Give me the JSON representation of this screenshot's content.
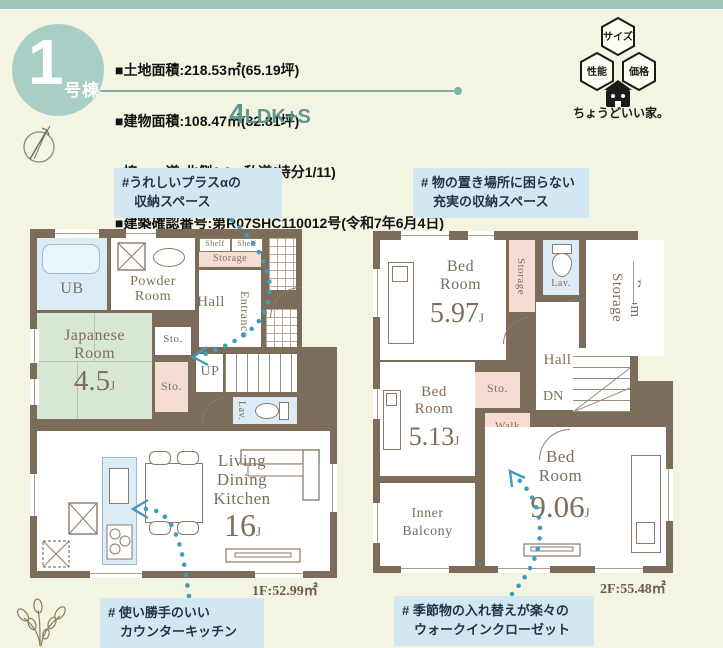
{
  "palette": {
    "accent_teal": "#5f978f",
    "wall_brown": "#7c6c5a",
    "tatami_green": "#d8e7d5",
    "water_blue": "#dcecf6",
    "storage_pink": "#f6ddd4",
    "annotation_bg": "#d3e7f3",
    "arrow_blue": "#3f9cbf",
    "badge_green": "#a9cec6",
    "topbar_green": "#9ec6bb",
    "plan_text": "#7e6e5c"
  },
  "header": {
    "badge": {
      "number": "1",
      "label": "号棟"
    },
    "property_lines": {
      "l1": "■土地面積:218.53㎡(65.19坪)",
      "l2": "■建物面積:108.47㎡(32.81坪)",
      "l3": "■接　　道:北側6.0m私道(持分1/11)",
      "l4": "■建築確認番号:第R07SHC110012号(令和7年6月4日)"
    },
    "plan_type": {
      "number": "4",
      "suffix": "LDK+S"
    },
    "logo": {
      "hex_top": "サイズ",
      "hex_left": "性能",
      "hex_right": "価格",
      "tagline": "ちょうどいい家。"
    }
  },
  "annotations": {
    "plus_storage": {
      "line1": "#うれしいプラスαの",
      "line2": "収納スペース"
    },
    "rich_storage": {
      "line1": "# 物の置き場所に困らない",
      "line2": "充実の収納スペース"
    },
    "counter_kitchen": {
      "line1": "# 使い勝手のいい",
      "line2": "カウンターキッチン"
    },
    "wic": {
      "line1": "# 季節物の入れ替えが楽々の",
      "line2": "ウォークインクローゼット"
    }
  },
  "floor1": {
    "area_label": "1F:52.99㎡",
    "rooms": {
      "ub": "UB",
      "powder": {
        "line1": "Powder",
        "line2": "Room"
      },
      "shelf_left": "Shelf",
      "shelf_right": "Shelf",
      "storage": "Storage",
      "hall": "Hall",
      "entrance": "Entrance",
      "sto_upper": "Sto.",
      "sto_lower": "Sto.",
      "stairs": "UP",
      "lav": "Lav.",
      "japanese": {
        "line1": "Japanese",
        "line2": "Room",
        "size": "4.5",
        "unit": "J"
      },
      "ldk": {
        "line1": "Living",
        "line2": "Dining",
        "line3": "Kitchen",
        "size": "16",
        "unit": "J"
      }
    }
  },
  "floor2": {
    "area_label": "2F:55.48㎡",
    "rooms": {
      "bed1": {
        "line1": "Bed",
        "line2": "Room",
        "size": "5.97",
        "unit": "J"
      },
      "bed2": {
        "line1": "Bed",
        "line2": "Room",
        "size": "5.13",
        "unit": "J"
      },
      "bed3": {
        "line1": "Bed",
        "line2": "Room",
        "size": "9.06",
        "unit": "J"
      },
      "storage_strip": "Storage",
      "lav": "Lav.",
      "storage_room": {
        "line1": "Storage",
        "line2": "Room"
      },
      "hall": "Hall",
      "sto": "Sto.",
      "stairs": "DN",
      "wic": {
        "line1": "Walk",
        "line2": "In",
        "line3": "Closet"
      },
      "balcony": {
        "line1": "Inner",
        "line2": "Balcony"
      }
    }
  }
}
